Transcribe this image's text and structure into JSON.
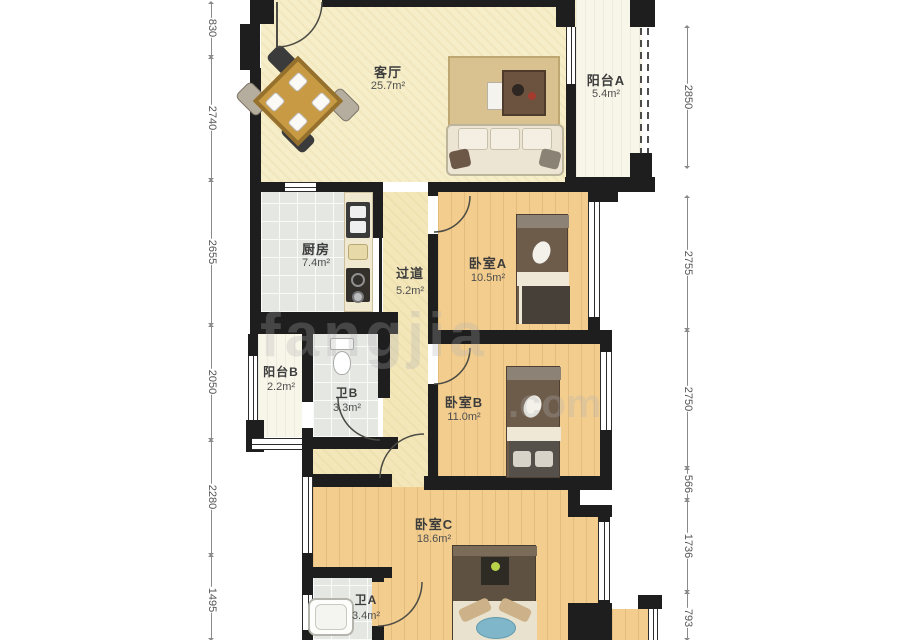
{
  "plan_title": "3室2卫户型图",
  "rooms": {
    "living": {
      "name": "客厅",
      "area": "25.7m²"
    },
    "balcony_a": {
      "name": "阳台A",
      "area": "5.4m²"
    },
    "kitchen": {
      "name": "厨房",
      "area": "7.4m²"
    },
    "hallway": {
      "name": "过道",
      "area": "5.2m²"
    },
    "bedroom_a": {
      "name": "卧室A",
      "area": "10.5m²"
    },
    "balcony_b": {
      "name": "阳台B",
      "area": "2.2m²"
    },
    "bath_b": {
      "name": "卫B",
      "area": "3.3m²"
    },
    "bedroom_b": {
      "name": "卧室B",
      "area": "11.0m²"
    },
    "bedroom_c": {
      "name": "卧室C",
      "area": "18.6m²"
    },
    "bath_a": {
      "name": "卫A",
      "area": "3.4m²"
    }
  },
  "dimensions": {
    "left": [
      "830",
      "2740",
      "2655",
      "2050",
      "2280",
      "1495"
    ],
    "right": [
      "2850",
      "2755",
      "2750",
      "566",
      "1736",
      "793"
    ]
  },
  "watermark": {
    "main": "fangjia",
    "suffix": ".com"
  },
  "colors": {
    "wall": "#1e1e1e",
    "wood_floor": "#f2cd8e",
    "living_floor": "#f6eec9",
    "tile_floor": "#e5e7e2",
    "dim_text": "#555555"
  }
}
